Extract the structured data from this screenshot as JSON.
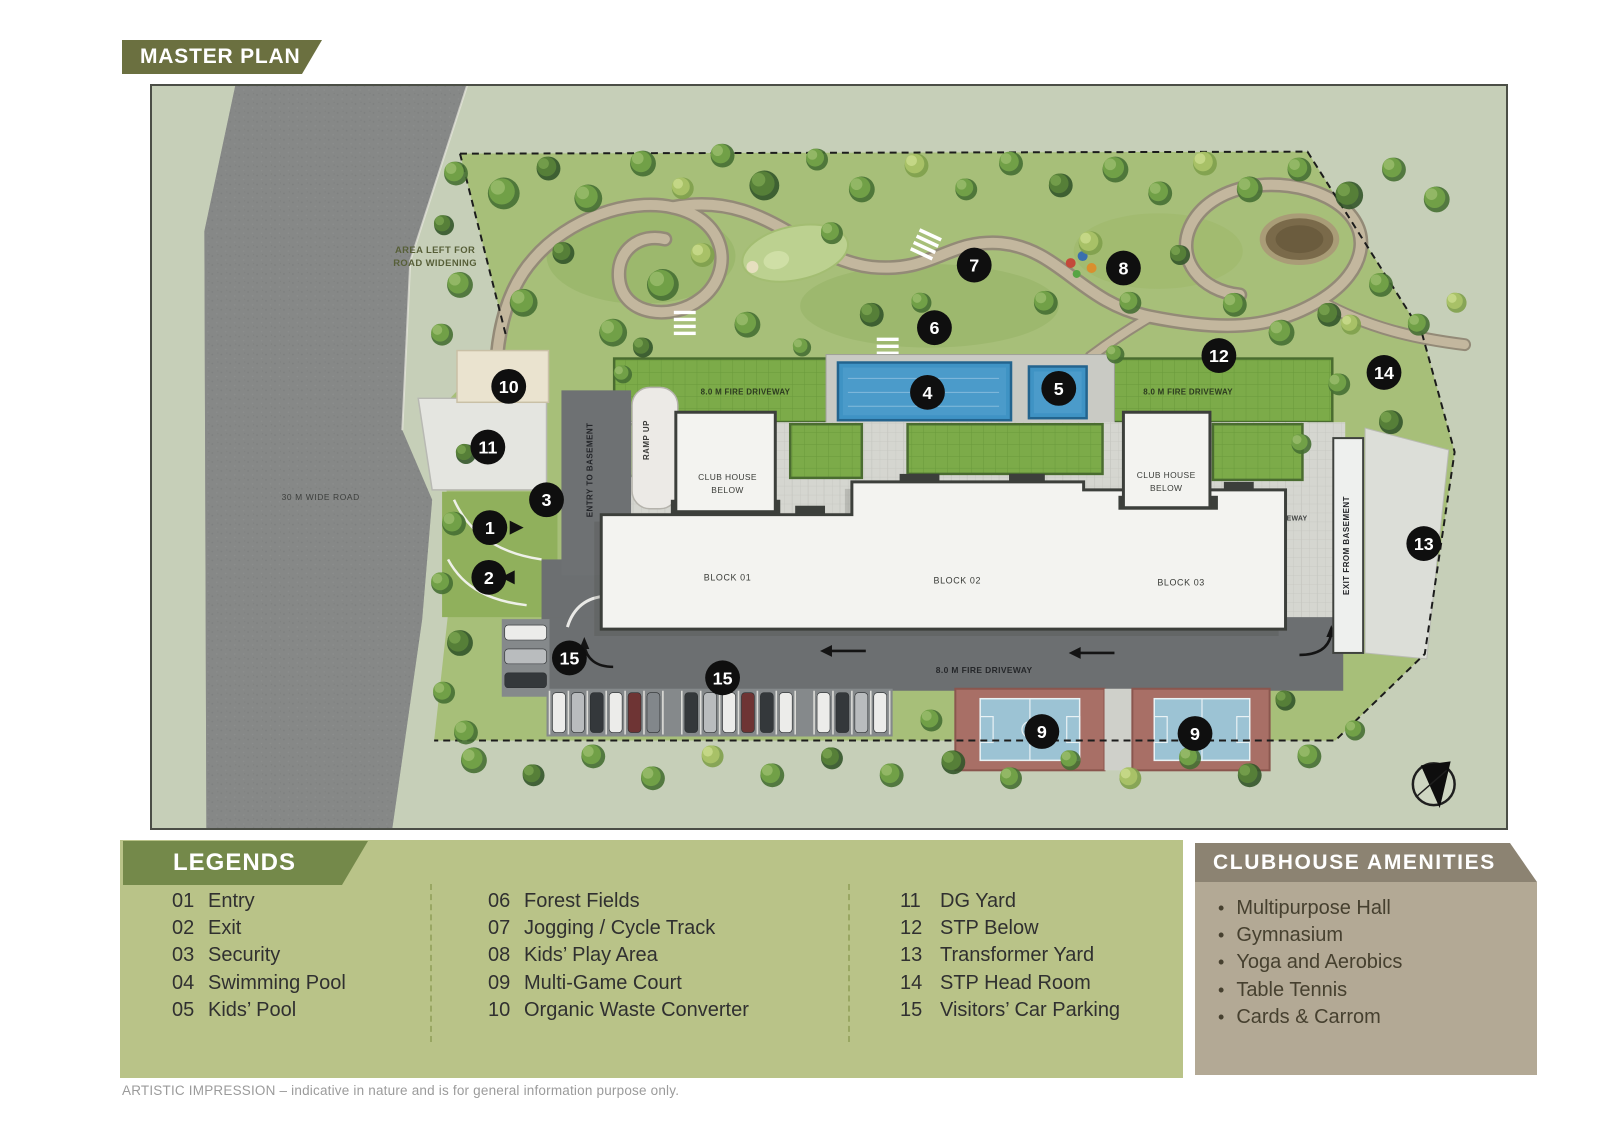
{
  "page": {
    "banner": "MASTER PLAN",
    "disclaimer": "ARTISTIC IMPRESSION – indicative in nature and is for general information purpose only."
  },
  "map": {
    "labels": {
      "area_left_line1": "AREA LEFT FOR",
      "area_left_line2": "ROAD WIDENING",
      "wide_road": "30 M WIDE ROAD",
      "fire_driveway": "8.0 M FIRE DRIVEWAY",
      "entry_basement": "ENTRY TO BASEMENT",
      "ramp_up": "RAMP UP",
      "club_house_line1": "CLUB HOUSE",
      "club_house_line2": "BELOW",
      "block_01": "BLOCK 01",
      "block_02": "BLOCK 02",
      "block_03": "BLOCK 03",
      "exit_basement": "EXIT FROM BASEMENT"
    },
    "markers": [
      "1",
      "2",
      "3",
      "4",
      "5",
      "6",
      "7",
      "8",
      "9",
      "9",
      "10",
      "11",
      "12",
      "13",
      "14",
      "15",
      "15"
    ]
  },
  "legends": {
    "title": "LEGENDS",
    "columns": [
      {
        "items": [
          {
            "num": "01",
            "label": "Entry"
          },
          {
            "num": "02",
            "label": "Exit"
          },
          {
            "num": "03",
            "label": "Security"
          },
          {
            "num": "04",
            "label": "Swimming Pool"
          },
          {
            "num": "05",
            "label": "Kids’ Pool"
          }
        ]
      },
      {
        "items": [
          {
            "num": "06",
            "label": "Forest Fields"
          },
          {
            "num": "07",
            "label": "Jogging / Cycle Track"
          },
          {
            "num": "08",
            "label": "Kids’ Play Area"
          },
          {
            "num": "09",
            "label": "Multi-Game Court"
          },
          {
            "num": "10",
            "label": "Organic Waste Converter"
          }
        ]
      },
      {
        "items": [
          {
            "num": "11",
            "label": "DG Yard"
          },
          {
            "num": "12",
            "label": "STP Below"
          },
          {
            "num": "13",
            "label": "Transformer Yard"
          },
          {
            "num": "14",
            "label": "STP Head Room"
          },
          {
            "num": "15",
            "label": "Visitors’ Car Parking"
          }
        ]
      }
    ]
  },
  "amenities": {
    "title": "CLUBHOUSE AMENITIES",
    "items": [
      "Multipurpose Hall",
      "Gymnasium",
      "Yoga and Aerobics",
      "Table Tennis",
      "Cards & Carrom"
    ]
  },
  "colors": {
    "banner_olive": "#6b7040",
    "legend_bg": "#b9c388",
    "legend_banner": "#74894a",
    "panel_bg": "#b3a995",
    "panel_header": "#8c8372",
    "marker_black": "#0f0f0f",
    "pool_blue": "#3f93c4",
    "court_blue": "#9cc3d4",
    "court_red": "#a86f66",
    "lawn_green": "#a7bf79",
    "driveway_lawn": "#7cab49",
    "road_gray": "#868887",
    "driveway_dark": "#6c6f71"
  }
}
